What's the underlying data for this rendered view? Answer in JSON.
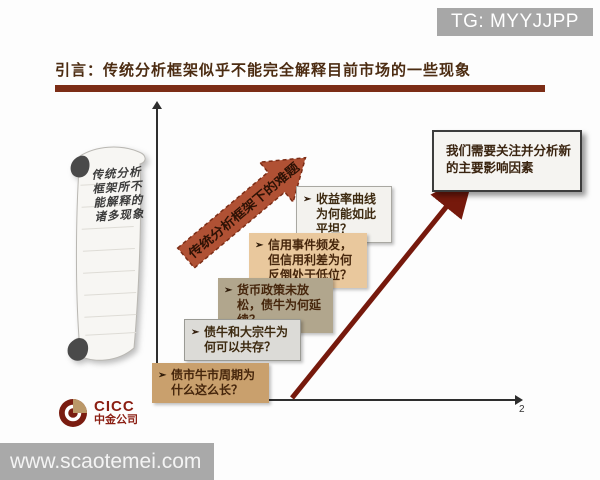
{
  "header": {
    "tg_watermark": "TG: MYYJJPP",
    "title": "引言：传统分析框架似乎不能完全解释目前市场的一些现象"
  },
  "scroll": {
    "lines": [
      "传统分析",
      "框架所不",
      "能解释的",
      "诸多现象"
    ]
  },
  "diagram": {
    "rising_arrow_label": "传统分析框架下的难题",
    "bullet": "➢",
    "question_boxes": [
      {
        "text": "收益率曲线为何能如此平坦？"
      },
      {
        "text": "信用事件频发，但信用利差为何反倒处于低位？"
      },
      {
        "text": "货币政策未放松，债牛为何延续？"
      },
      {
        "text": "债牛和大宗牛为何可以共存？"
      },
      {
        "text": "债市牛市周期为什么这么长？"
      }
    ],
    "conclusion_box": "我们需要关注并分析新的主要影响因素"
  },
  "footer": {
    "logo_text": "CICC",
    "logo_cn": "中金公司",
    "page_number": "2",
    "url_watermark": "www.scaotemei.com"
  },
  "colors": {
    "title_accent": "#7c2d16",
    "rust_arrow": "#b05134",
    "dark_arrow": "#76190c",
    "watermark_gray": "#a8a8a8",
    "box_peach": "#e9c89d",
    "box_khaki": "#b1a68d",
    "box_tan": "#c9a06d",
    "box_light": "#f3f2ee",
    "logo_maroon": "#7a1c10",
    "logo_gold": "#bb9868"
  }
}
